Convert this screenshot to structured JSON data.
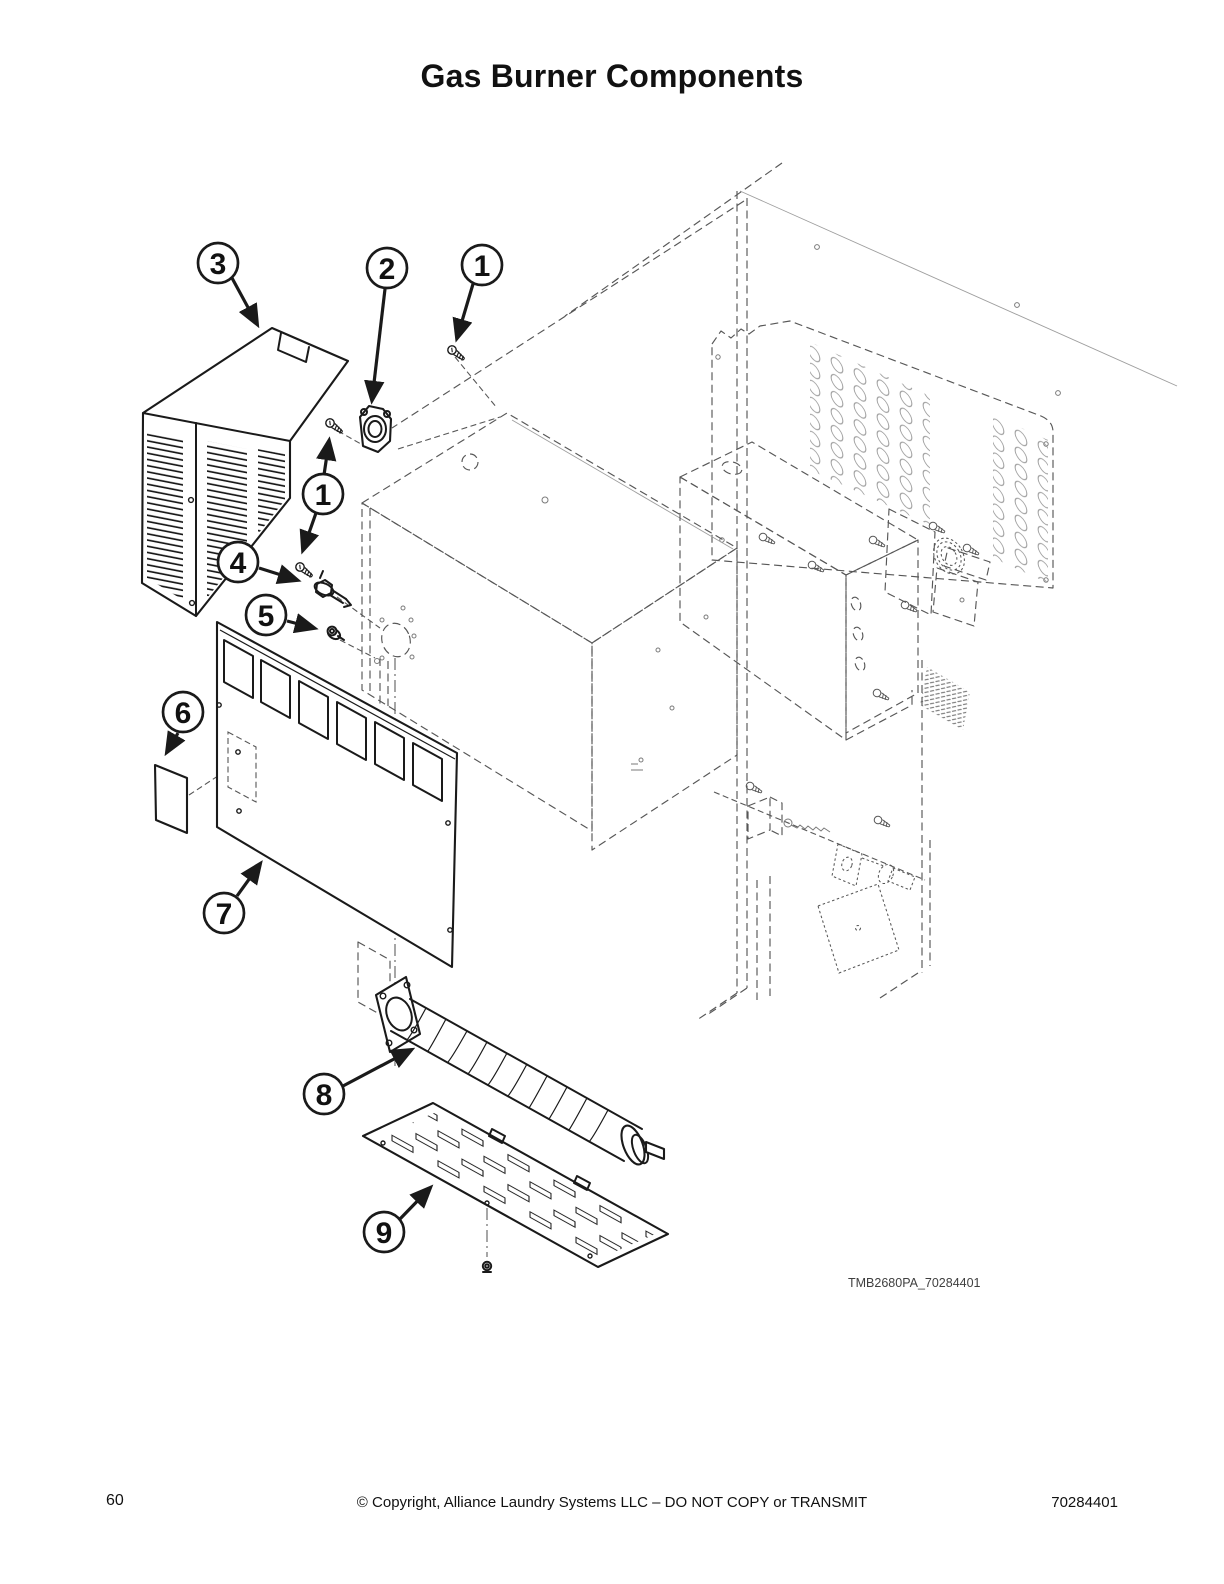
{
  "page": {
    "title": "Gas Burner Components"
  },
  "figure": {
    "caption": "TMB2680PA_70284401",
    "callouts": [
      {
        "label": "3"
      },
      {
        "label": "2"
      },
      {
        "label": "1"
      },
      {
        "label": "1"
      },
      {
        "label": "4"
      },
      {
        "label": "5"
      },
      {
        "label": "6"
      },
      {
        "label": "7"
      },
      {
        "label": "8"
      },
      {
        "label": "9"
      }
    ]
  },
  "footer": {
    "page_number": "60",
    "copyright": "© Copyright, Alliance Laundry Systems LLC – DO NOT COPY or TRANSMIT",
    "doc_number": "70284401"
  }
}
